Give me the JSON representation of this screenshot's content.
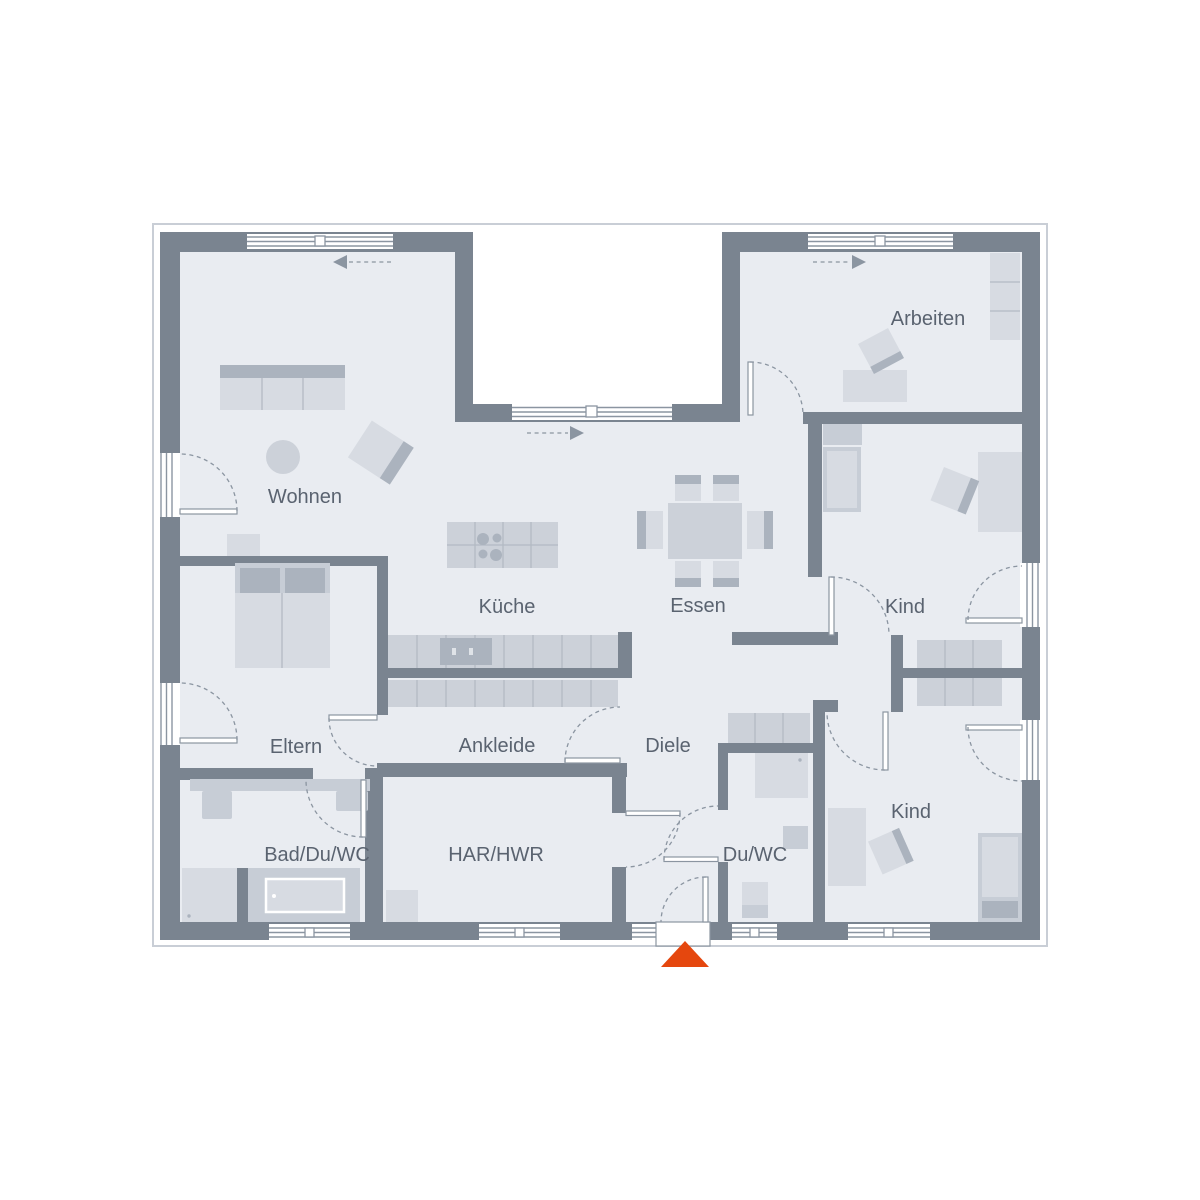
{
  "plan": {
    "type": "residential-floor-plan",
    "rooms": [
      {
        "id": "wohnen",
        "label": "Wohnen"
      },
      {
        "id": "kueche",
        "label": "Küche"
      },
      {
        "id": "essen",
        "label": "Essen"
      },
      {
        "id": "arbeiten",
        "label": "Arbeiten"
      },
      {
        "id": "kind-1",
        "label": "Kind"
      },
      {
        "id": "kind-2",
        "label": "Kind"
      },
      {
        "id": "eltern",
        "label": "Eltern"
      },
      {
        "id": "ankleide",
        "label": "Ankleide"
      },
      {
        "id": "diele",
        "label": "Diele"
      },
      {
        "id": "bad",
        "label": "Bad/Du/WC"
      },
      {
        "id": "har",
        "label": "HAR/HWR"
      },
      {
        "id": "du-wc",
        "label": "Du/WC"
      }
    ],
    "entrance": {
      "symbol": "triangle-arrow-up",
      "position": "bottom-center"
    },
    "sliding_door_arrows": [
      {
        "location": "wohnen-top",
        "direction": "left"
      },
      {
        "location": "terrace-notch",
        "direction": "right"
      },
      {
        "location": "arbeiten-top",
        "direction": "right"
      }
    ],
    "furniture": [
      "sofa",
      "round-rug",
      "armchair",
      "sideboard",
      "kitchen-island",
      "cooktop",
      "kitchen-counter",
      "sink",
      "dining-table",
      "dining-chairs-6",
      "desk",
      "office-chair",
      "shelf",
      "double-bed",
      "single-bed",
      "single-bed",
      "wardrobe",
      "hall-closet",
      "bathtub",
      "shower",
      "shower",
      "vanity",
      "wc",
      "wc",
      "washbasin",
      "washing-machine"
    ]
  },
  "colors": {
    "wall": "#7a8490",
    "floor": "#e9ecf1",
    "outside": "#ffffff",
    "roof-line": "#c9ced6",
    "furn-light": "#d7dbe2",
    "furn-mid": "#c7cdd6",
    "furn-dark": "#abb3be",
    "counter": "#ccd1d9",
    "divider": "#b3bac4",
    "line": "#8b95a1",
    "label": "#5a6370",
    "arrow": "#e5470e"
  }
}
